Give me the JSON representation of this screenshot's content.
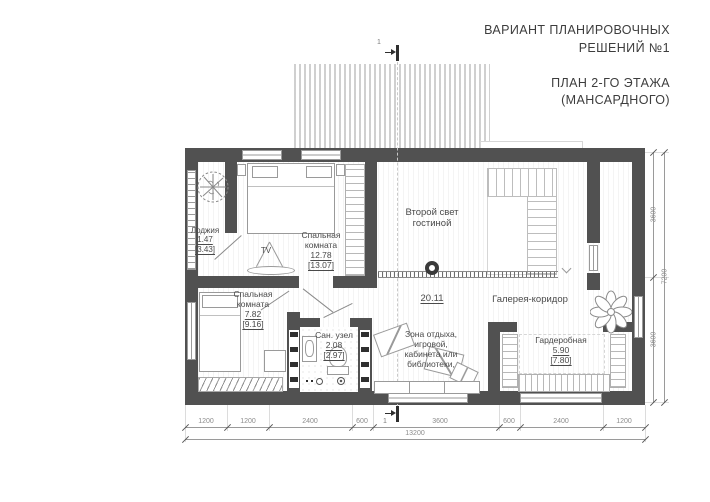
{
  "title_block": {
    "line1": "ВАРИАНТ ПЛАНИРОВОЧНЫХ",
    "line2": "РЕШЕНИЙ №1",
    "line3": "ПЛАН 2-ГО ЭТАЖА",
    "line4": "(МАНСАРДНОГО)"
  },
  "rooms": {
    "loggia": {
      "name": "Лоджия",
      "area": "1.47",
      "area_total": "[3.43]"
    },
    "bedroom_top": {
      "name_line1": "Спальная",
      "name_line2": "комната",
      "area": "12.78",
      "area_total": "[13.07]"
    },
    "second_light": {
      "name_line1": "Второй свет",
      "name_line2": "гостиной"
    },
    "gallery": {
      "name": "Галерея-коридор",
      "area": "20.11"
    },
    "bedroom_bottom": {
      "name_line1": "Спальная",
      "name_line2": "комната",
      "area": "7.82",
      "area_total": "[9.16]"
    },
    "bathroom": {
      "name": "Сан. узел",
      "area": "2.08",
      "area_total": "[2.97]"
    },
    "lounge": {
      "line1": "Зона отдыха,",
      "line2": "игровой,",
      "line3": "кабинета или",
      "line4": "библиотеки,"
    },
    "wardrobe": {
      "name": "Гардеробная",
      "area": "5.90",
      "area_total": "[7.80]"
    }
  },
  "furniture": {
    "tv_label": "TV"
  },
  "dimensions": {
    "bottom_segments": [
      "1200",
      "1200",
      "2400",
      "600",
      "3600",
      "600",
      "2400",
      "1200"
    ],
    "bottom_total": "13200",
    "right_segments": [
      "3600",
      "3600"
    ],
    "right_total": "7200"
  },
  "section_marker": {
    "label": "1"
  },
  "colors": {
    "wall": "#515151",
    "dim_text": "#8c8c8c",
    "label_text": "#4a4a4a",
    "roof_hatch": "#c7c7c7"
  }
}
